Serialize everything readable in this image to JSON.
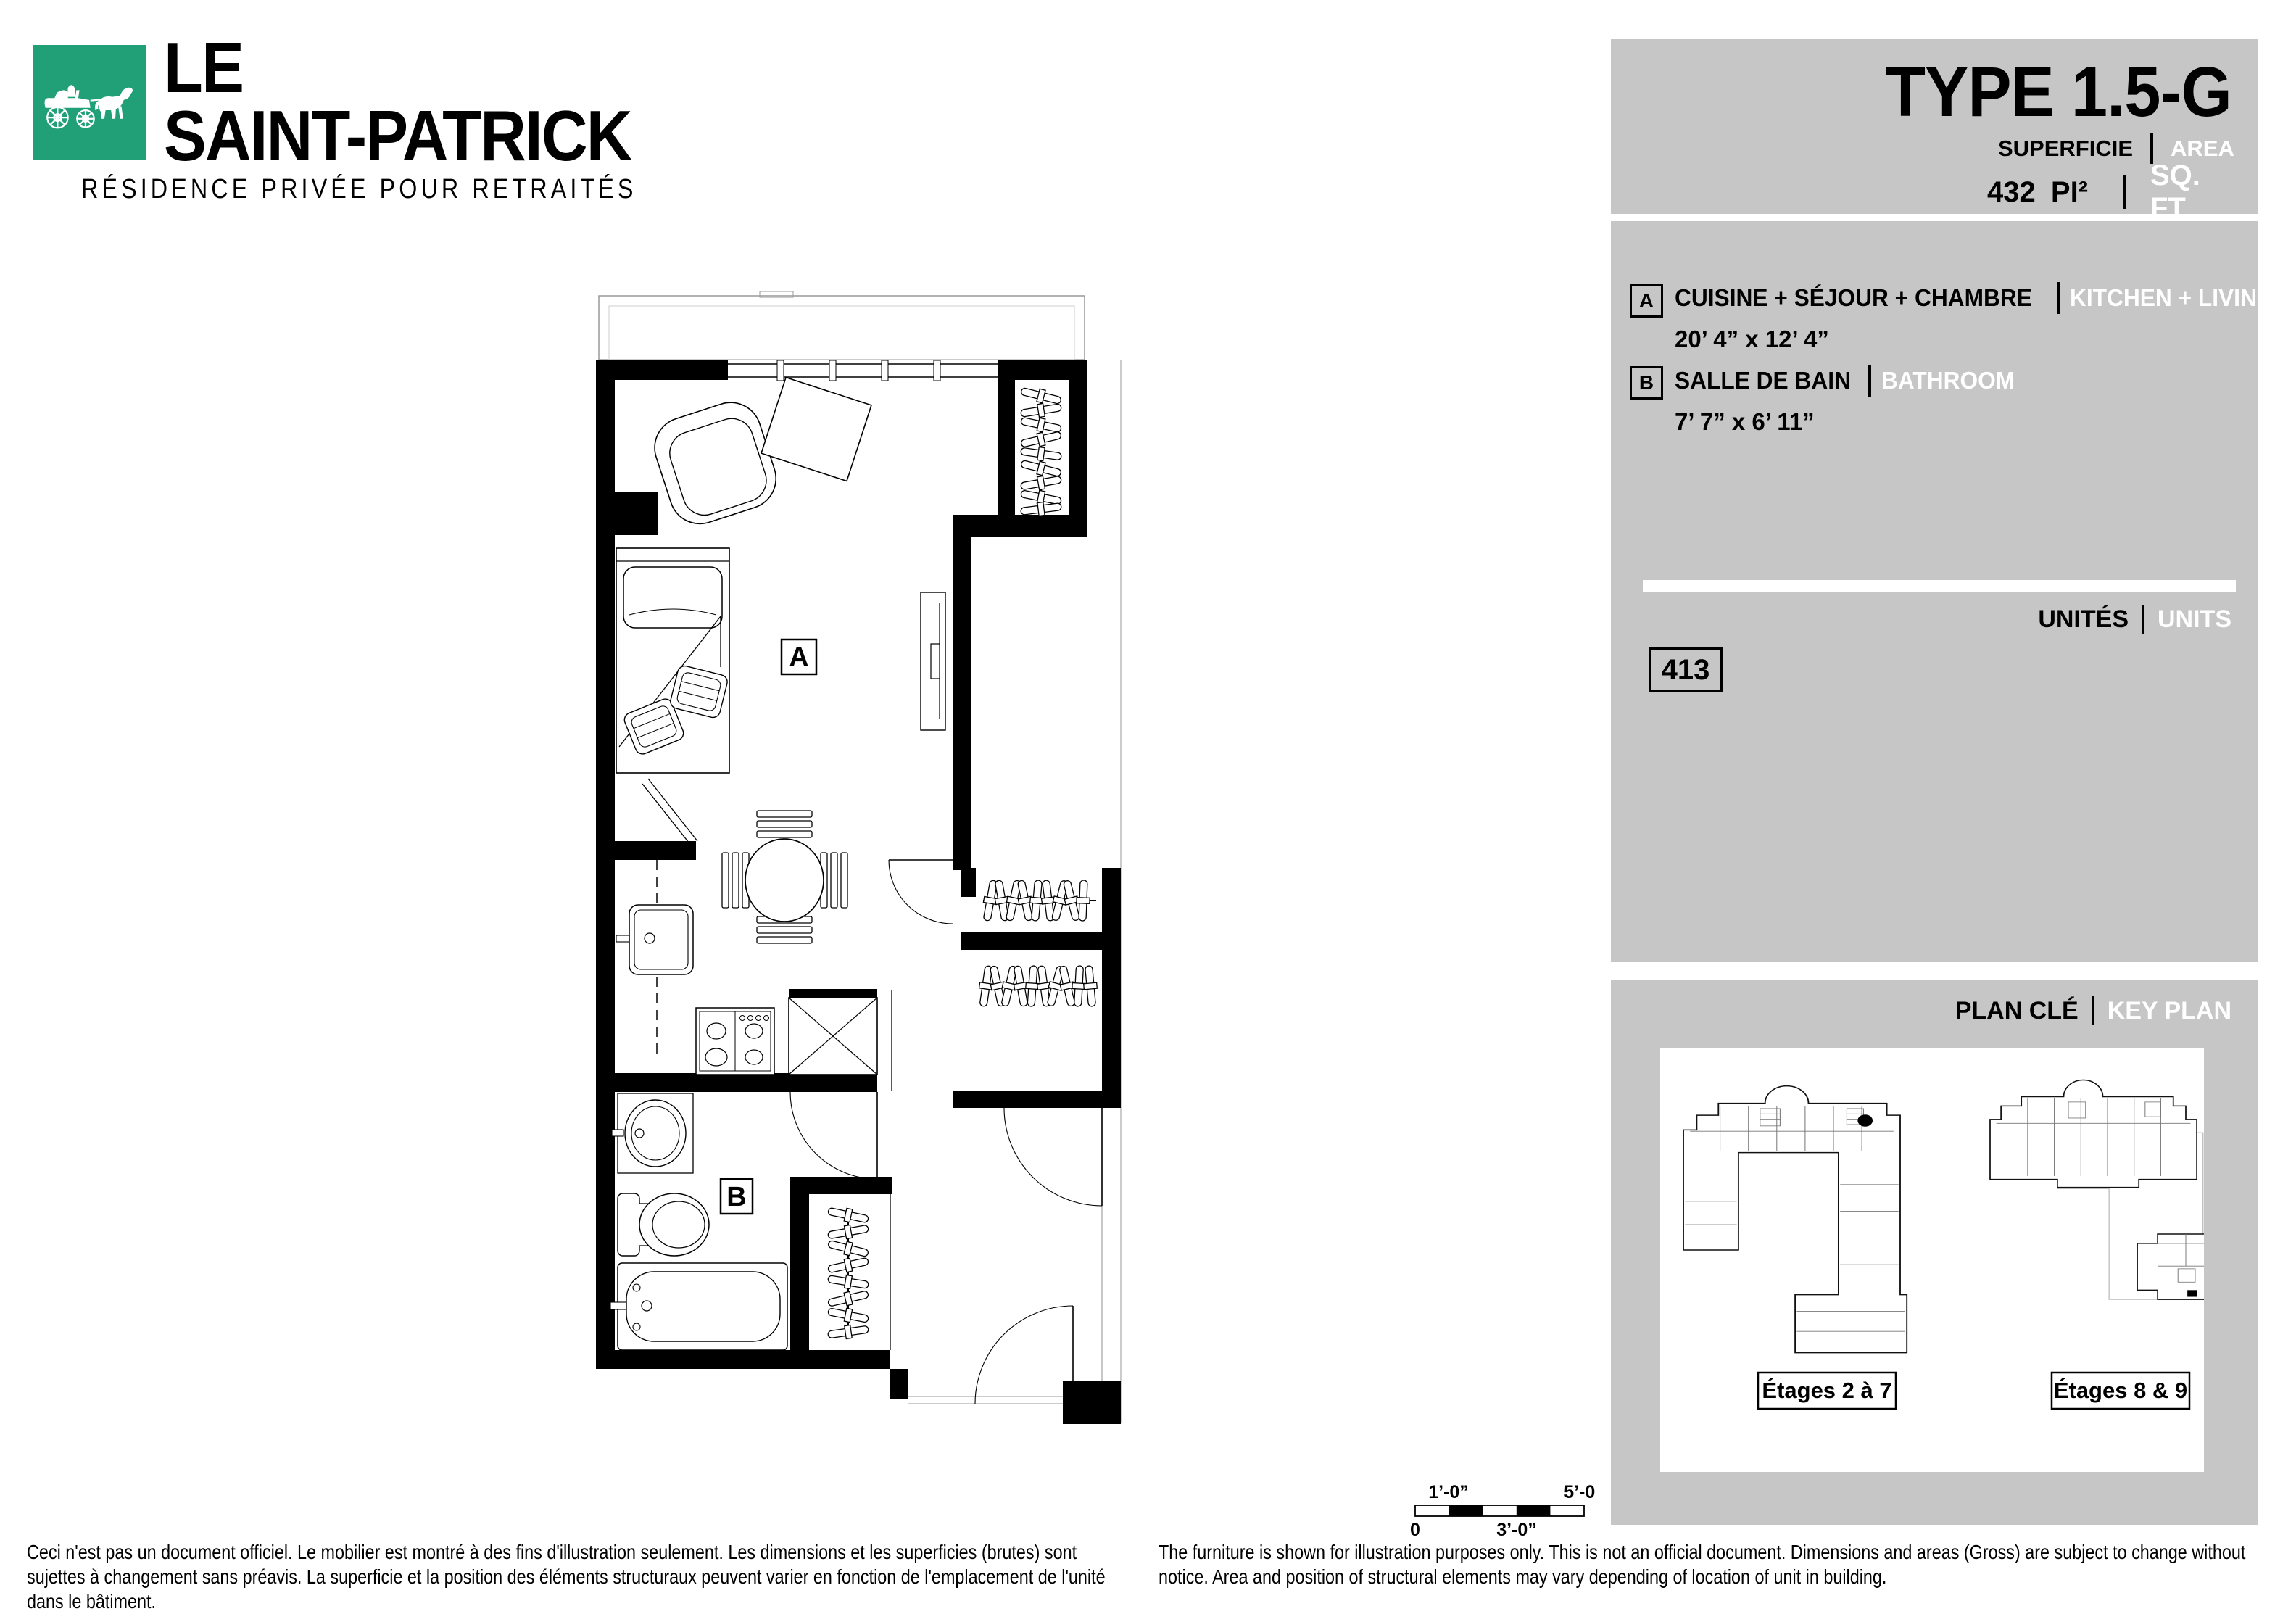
{
  "brand": {
    "name_line1": "LE",
    "name_line2": "SAINT-PATRICK",
    "tagline": "RÉSIDENCE PRIVÉE POUR RETRAITÉS",
    "logo_icon": "horse-carriage-icon",
    "brand_green": "#21A077"
  },
  "unit_header": {
    "title": "TYPE 1.5-G",
    "superficie_label": "SUPERFICIE",
    "area_label": "AREA",
    "area_value": "432 PI²",
    "area_unit_en": "SQ. FT"
  },
  "legend": {
    "items": [
      {
        "key": "A",
        "name_fr": "CUISINE + SÉJOUR + CHAMBRE",
        "name_en": "KITCHEN + LIVING ROOM + BEDROOM",
        "dimensions": "20’ 4” x 12’ 4”"
      },
      {
        "key": "B",
        "name_fr": "SALLE DE BAIN",
        "name_en": "BATHROOM",
        "dimensions": "7’ 7” x 6’ 11”"
      }
    ]
  },
  "units": {
    "label_fr": "UNITÉS",
    "label_en": "UNITS",
    "numbers": [
      "413"
    ]
  },
  "key_plan": {
    "label_fr": "PLAN CLÉ",
    "label_en": "KEY PLAN",
    "floor_labels": [
      "Étages 2 à 7",
      "Étages 8 & 9"
    ]
  },
  "plan": {
    "labels": [
      "A",
      "B"
    ]
  },
  "scale_bar": {
    "top_left": "1’-0”",
    "top_right": "5’-0”",
    "bottom_left": "0",
    "bottom_mid": "3’-0”"
  },
  "disclaimers": {
    "fr": "Ceci n'est pas un document officiel. Le mobilier est montré à des fins d'illustration seulement. Les dimensions et les superficies (brutes) sont sujettes à changement sans préavis. La superficie et la position des éléments structuraux peuvent varier en fonction de l'emplacement de l'unité dans le bâtiment.",
    "en": "The furniture is shown for illustration purposes only. This is not an official document. Dimensions and areas (Gross) are subject to change without notice. Area and position of structural elements may vary depending of location of unit in building."
  },
  "colors": {
    "panel_gray": "#c6c6c6",
    "brand_green": "#21A077",
    "text_black": "#000000",
    "text_white": "#ffffff"
  }
}
